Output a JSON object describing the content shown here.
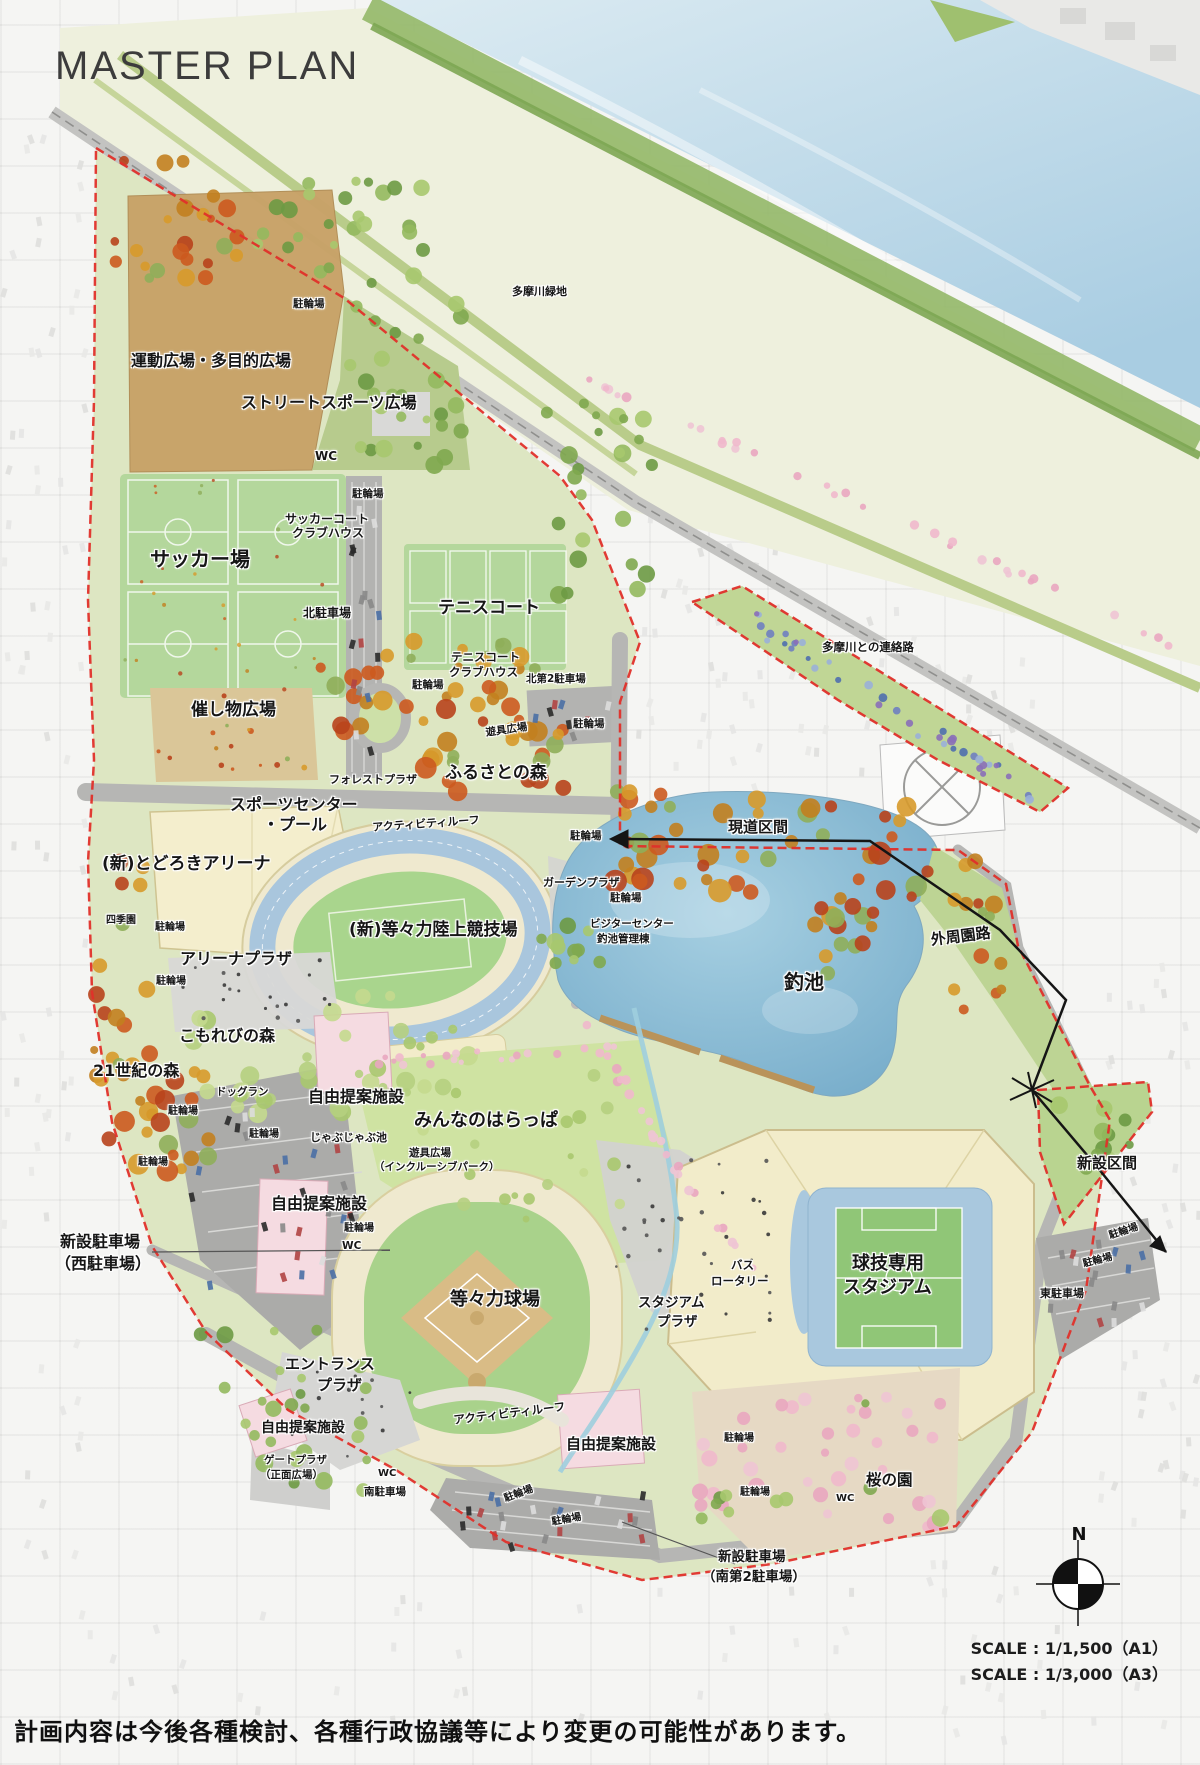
{
  "title": "MASTER PLAN",
  "compass": {
    "label": "N"
  },
  "scale": {
    "line1": "SCALE : 1/1,500（A1）",
    "line2": "SCALE : 1/3,000（A3）"
  },
  "disclaimer": "計画内容は今後各種検討、各種行政協議等により変更の可能性があります。",
  "colors": {
    "boundary_dash": "#e0302a",
    "route_line": "#151515",
    "pond_water": "#7fb4d4",
    "river_water": "#b7d6e6",
    "field_green": "#b4d79c",
    "proposal_pink": "#f5dbe1",
    "stadium_cream": "#f2ecca"
  },
  "map_labels": [
    {
      "t": "多摩川緑地",
      "x": 512,
      "y": 286,
      "s": 11
    },
    {
      "t": "駐輪場",
      "x": 293,
      "y": 299,
      "s": 10.5
    },
    {
      "t": "運動広場・多目的広場",
      "x": 131,
      "y": 353,
      "s": 16
    },
    {
      "t": "ストリートスポーツ広場",
      "x": 241,
      "y": 395,
      "s": 16
    },
    {
      "t": "WC",
      "x": 315,
      "y": 450,
      "s": 12
    },
    {
      "t": "駐輪場",
      "x": 352,
      "y": 489,
      "s": 10.5
    },
    {
      "t": "サッカーコート",
      "x": 285,
      "y": 513,
      "s": 12
    },
    {
      "t": "クラブハウス",
      "x": 292,
      "y": 527,
      "s": 12
    },
    {
      "t": "サッカー場",
      "x": 150,
      "y": 549,
      "s": 20
    },
    {
      "t": "北駐車場",
      "x": 303,
      "y": 607,
      "s": 12
    },
    {
      "t": "テニスコート",
      "x": 438,
      "y": 600,
      "s": 17
    },
    {
      "t": "テニスコート",
      "x": 451,
      "y": 652,
      "s": 11.5
    },
    {
      "t": "クラブハウス",
      "x": 449,
      "y": 667,
      "s": 11.5
    },
    {
      "t": "駐輪場",
      "x": 412,
      "y": 680,
      "s": 10.5
    },
    {
      "t": "北第2駐車場",
      "x": 526,
      "y": 674,
      "s": 10.5
    },
    {
      "t": "催し物広場",
      "x": 191,
      "y": 702,
      "s": 17
    },
    {
      "t": "遊具広場",
      "x": 485,
      "y": 728,
      "s": 10.5,
      "r": -8
    },
    {
      "t": "駐輪場",
      "x": 573,
      "y": 719,
      "s": 10.5
    },
    {
      "t": "フォレストプラザ",
      "x": 329,
      "y": 774,
      "s": 11
    },
    {
      "t": "ふるさとの森",
      "x": 445,
      "y": 765,
      "s": 17
    },
    {
      "t": "スポーツセンター",
      "x": 230,
      "y": 797,
      "s": 16
    },
    {
      "t": "・プール",
      "x": 263,
      "y": 817,
      "s": 16
    },
    {
      "t": "アクティビティルーフ",
      "x": 372,
      "y": 822,
      "s": 11,
      "r": -4
    },
    {
      "t": "(新)とどろきアリーナ",
      "x": 102,
      "y": 856,
      "s": 17
    },
    {
      "t": "四季園",
      "x": 106,
      "y": 916,
      "s": 10
    },
    {
      "t": "駐輪場",
      "x": 155,
      "y": 923,
      "s": 10
    },
    {
      "t": "アリーナプラザ",
      "x": 180,
      "y": 951,
      "s": 16
    },
    {
      "t": "駐輪場",
      "x": 156,
      "y": 977,
      "s": 10
    },
    {
      "t": "(新)等々力陸上競技場",
      "x": 349,
      "y": 922,
      "s": 17
    },
    {
      "t": "駐輪場",
      "x": 570,
      "y": 831,
      "s": 10.5
    },
    {
      "t": "ガーデンプラザ",
      "x": 543,
      "y": 877,
      "s": 11
    },
    {
      "t": "駐輪場",
      "x": 610,
      "y": 893,
      "s": 10.5
    },
    {
      "t": "ビジターセンター",
      "x": 590,
      "y": 919,
      "s": 10.5
    },
    {
      "t": "釣池管理棟",
      "x": 597,
      "y": 934,
      "s": 10.5
    },
    {
      "t": "現道区間",
      "x": 728,
      "y": 820,
      "s": 15
    },
    {
      "t": "多摩川との連絡路",
      "x": 822,
      "y": 642,
      "s": 11.5
    },
    {
      "t": "外周園路",
      "x": 930,
      "y": 933,
      "s": 15,
      "r": -7
    },
    {
      "t": "釣池",
      "x": 784,
      "y": 972,
      "s": 20
    },
    {
      "t": "こもれびの森",
      "x": 179,
      "y": 1028,
      "s": 16
    },
    {
      "t": "21世紀の森",
      "x": 93,
      "y": 1063,
      "s": 16
    },
    {
      "t": "ドッグラン",
      "x": 216,
      "y": 1087,
      "s": 10.5
    },
    {
      "t": "駐輪場",
      "x": 168,
      "y": 1107,
      "s": 10
    },
    {
      "t": "駐輪場",
      "x": 249,
      "y": 1130,
      "s": 10
    },
    {
      "t": "駐輪場",
      "x": 138,
      "y": 1158,
      "s": 10
    },
    {
      "t": "自由提案施設",
      "x": 308,
      "y": 1089,
      "s": 16
    },
    {
      "t": "じゃぶじゃぶ池",
      "x": 310,
      "y": 1132,
      "s": 11
    },
    {
      "t": "みんなのはらっぱ",
      "x": 414,
      "y": 1112,
      "s": 18
    },
    {
      "t": "遊具広場",
      "x": 409,
      "y": 1148,
      "s": 10.5
    },
    {
      "t": "（インクルーシブパーク）",
      "x": 374,
      "y": 1162,
      "s": 10.5
    },
    {
      "t": "自由提案施設",
      "x": 271,
      "y": 1196,
      "s": 16
    },
    {
      "t": "駐輪場",
      "x": 344,
      "y": 1224,
      "s": 10
    },
    {
      "t": "WC",
      "x": 342,
      "y": 1241,
      "s": 10.5
    },
    {
      "t": "新設駐車場",
      "x": 60,
      "y": 1234,
      "s": 16
    },
    {
      "t": "（西駐車場）",
      "x": 55,
      "y": 1256,
      "s": 16
    },
    {
      "t": "新設区間",
      "x": 1077,
      "y": 1156,
      "s": 15
    },
    {
      "t": "駐輪場",
      "x": 1108,
      "y": 1232,
      "s": 10,
      "r": -18
    },
    {
      "t": "駐輪場",
      "x": 1082,
      "y": 1260,
      "s": 10,
      "r": -14
    },
    {
      "t": "東駐車場",
      "x": 1040,
      "y": 1288,
      "s": 11
    },
    {
      "t": "球技専用",
      "x": 852,
      "y": 1255,
      "s": 18
    },
    {
      "t": "スタジアム",
      "x": 843,
      "y": 1279,
      "s": 18
    },
    {
      "t": "等々力球場",
      "x": 450,
      "y": 1291,
      "s": 18
    },
    {
      "t": "スタジアム",
      "x": 638,
      "y": 1297,
      "s": 13.5
    },
    {
      "t": "プラザ",
      "x": 657,
      "y": 1316,
      "s": 13.5
    },
    {
      "t": "バス",
      "x": 731,
      "y": 1260,
      "s": 11.5
    },
    {
      "t": "ロータリー",
      "x": 711,
      "y": 1276,
      "s": 11.5
    },
    {
      "t": "エントランス",
      "x": 285,
      "y": 1357,
      "s": 15
    },
    {
      "t": "プラザ",
      "x": 317,
      "y": 1378,
      "s": 15
    },
    {
      "t": "アクティビティルーフ",
      "x": 453,
      "y": 1415,
      "s": 11.5,
      "r": -7
    },
    {
      "t": "自由提案施設",
      "x": 566,
      "y": 1437,
      "s": 15
    },
    {
      "t": "駐輪場",
      "x": 724,
      "y": 1434,
      "s": 10
    },
    {
      "t": "自由提案施設",
      "x": 261,
      "y": 1421,
      "s": 14
    },
    {
      "t": "ゲートプラザ",
      "x": 264,
      "y": 1455,
      "s": 10.5
    },
    {
      "t": "（正面広場）",
      "x": 260,
      "y": 1470,
      "s": 10.5
    },
    {
      "t": "WC",
      "x": 378,
      "y": 1469,
      "s": 10
    },
    {
      "t": "南駐車場",
      "x": 364,
      "y": 1487,
      "s": 10.5
    },
    {
      "t": "駐輪場",
      "x": 503,
      "y": 1495,
      "s": 10,
      "r": -20
    },
    {
      "t": "駐輪場",
      "x": 551,
      "y": 1518,
      "s": 10,
      "r": -10
    },
    {
      "t": "駐輪場",
      "x": 740,
      "y": 1488,
      "s": 10
    },
    {
      "t": "WC",
      "x": 836,
      "y": 1494,
      "s": 10
    },
    {
      "t": "桜の園",
      "x": 866,
      "y": 1473,
      "s": 15.5
    },
    {
      "t": "新設駐車場",
      "x": 718,
      "y": 1551,
      "s": 13.5
    },
    {
      "t": "（南第2駐車場）",
      "x": 702,
      "y": 1571,
      "s": 13.5
    }
  ]
}
